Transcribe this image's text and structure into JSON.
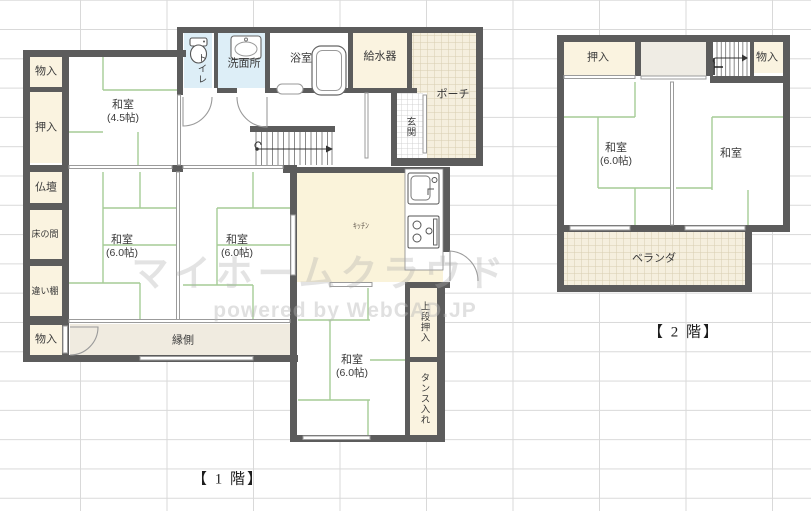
{
  "floor1": {
    "title": "【 1 階】",
    "left_column": {
      "storage_top": "物入",
      "closet": "押入",
      "altar": "仏壇",
      "tokonoma": "床の間",
      "shelf": "違い棚",
      "storage_bottom": "物入"
    },
    "rooms": {
      "washitsu_45": {
        "name": "和室",
        "size": "(4.5帖)"
      },
      "washitsu_60_left": {
        "name": "和室",
        "size": "(6.0帖)"
      },
      "washitsu_60_right": {
        "name": "和室",
        "size": "(6.0帖)"
      },
      "washitsu_60_south": {
        "name": "和室",
        "size": "(6.0帖)"
      },
      "kitchen": "ｷｯﾁﾝ",
      "engawa": "縁側"
    },
    "water": {
      "toilet": "トイレ",
      "washroom": "洗面所",
      "bath": "浴室",
      "water_heater": "給水器"
    },
    "entry": {
      "porch": "ポーチ",
      "genkan": "玄関"
    },
    "storage": {
      "upper_closet": "上段押入",
      "tansu": "タンス入れ"
    }
  },
  "floor2": {
    "title": "【 2 階】",
    "storage": {
      "closet": "押入",
      "storage": "物入"
    },
    "rooms": {
      "washitsu_60": {
        "name": "和室",
        "size": "(6.0帖)"
      },
      "washitsu": "和室",
      "veranda": "ベランダ"
    }
  },
  "watermark": {
    "line1": "マイホームクラウド",
    "line2": "powered by WebCAD.JP"
  },
  "colors": {
    "wall": "#5c5c5c",
    "tatami_line": "#a6cc96",
    "closet_fill": "#faf3e0",
    "wet_area_fill": "#ddeef7",
    "kitchen_fill": "#faf3da",
    "engawa_fill": "#f0ebe0",
    "porch_fill": "#f5efde",
    "porch_hatch": "#d8cdb0",
    "grid": "#d9d9d9"
  }
}
